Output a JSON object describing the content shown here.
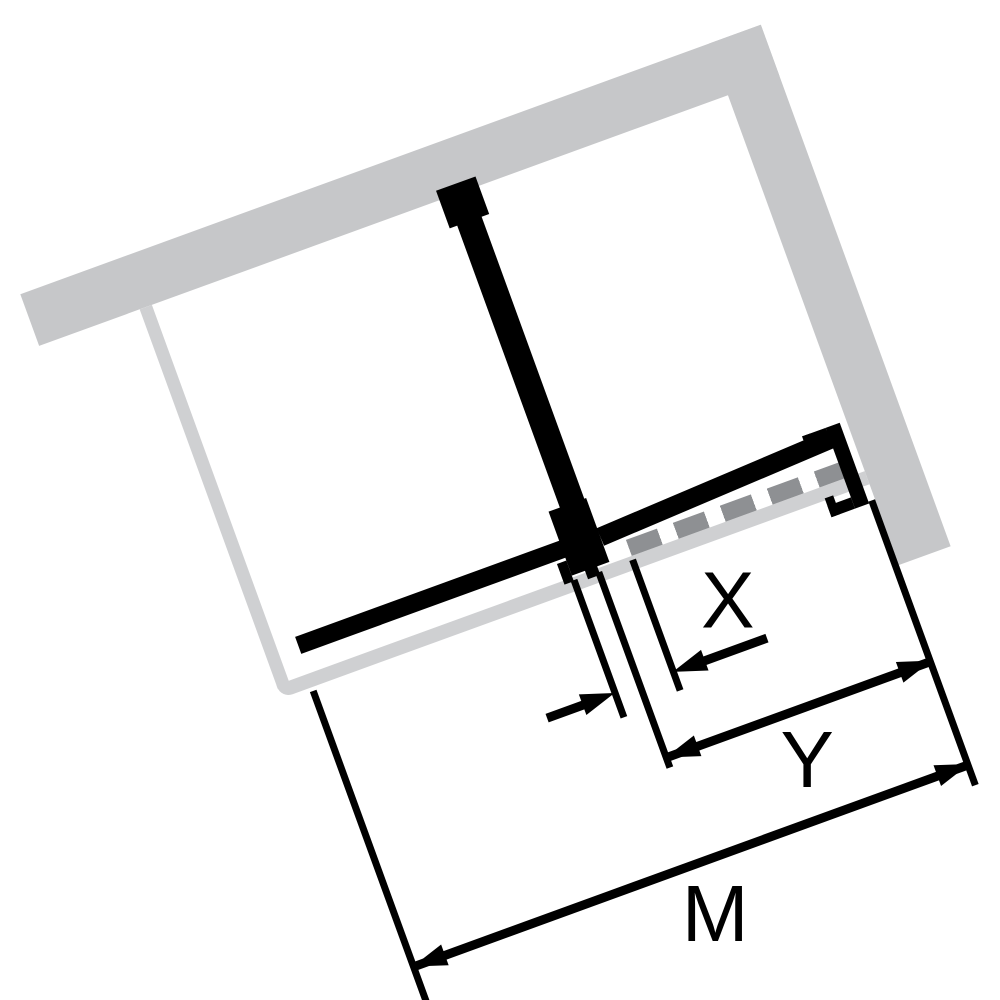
{
  "diagram": {
    "type": "shower-enclosure-plan-view",
    "description": "Tilted top-view installation diagram: L-shaped wall, fixed glass panel, side panel, door with wall mounting profile, shower tray outline, and dimension lines",
    "rotation_deg": -20,
    "colors": {
      "wall_gray": "#c6c7c9",
      "tray_gray": "#cfd0d2",
      "glass_black": "#000000",
      "dash_gray": "#8e9093",
      "background": "#ffffff"
    },
    "dimensions": {
      "x": {
        "label": "X"
      },
      "y": {
        "label": "Y"
      },
      "m": {
        "label": "M"
      }
    }
  }
}
